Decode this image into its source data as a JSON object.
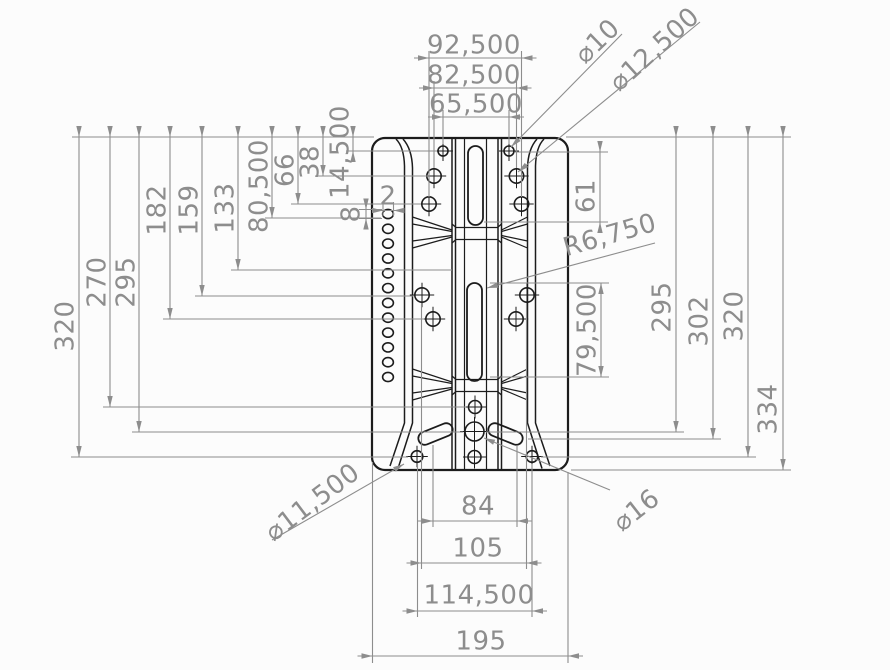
{
  "colors": {
    "background": "#fcfcfc",
    "part_line": "#1c1c1c",
    "dim": "#8d8d8d"
  },
  "dimensions": {
    "top": [
      {
        "label": "92,500"
      },
      {
        "label": "82,500"
      },
      {
        "label": "65,500"
      }
    ],
    "left": [
      {
        "label": "320"
      },
      {
        "label": "270"
      },
      {
        "label": "295"
      },
      {
        "label": "182"
      },
      {
        "label": "159"
      },
      {
        "label": "133"
      },
      {
        "label": "80,500"
      },
      {
        "label": "66"
      },
      {
        "label": "38"
      },
      {
        "label": "14,500"
      }
    ],
    "right": [
      {
        "label": "61"
      },
      {
        "label": "79,500"
      },
      {
        "label": "295"
      },
      {
        "label": "302"
      },
      {
        "label": "320"
      },
      {
        "label": "334"
      }
    ],
    "bottom": [
      {
        "label": "84"
      },
      {
        "label": "105"
      },
      {
        "label": "114,500"
      },
      {
        "label": "195"
      }
    ],
    "mini": [
      {
        "label": "2"
      },
      {
        "label": "8"
      }
    ],
    "leaders": [
      {
        "label": "⌀10"
      },
      {
        "label": "⌀12,500"
      },
      {
        "label": "R6,750"
      },
      {
        "label": "⌀11,500"
      },
      {
        "label": "⌀16"
      }
    ]
  }
}
